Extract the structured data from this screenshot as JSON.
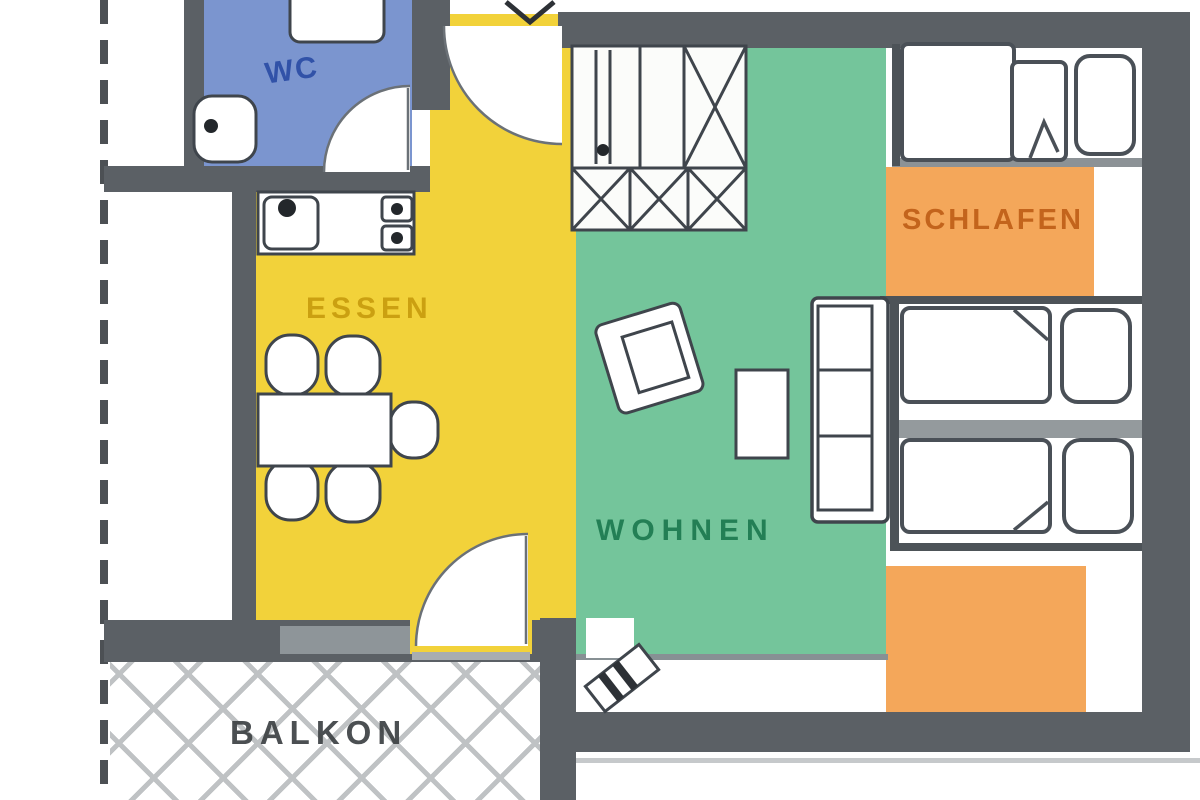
{
  "plan": {
    "type": "apartment-floor-plan",
    "rooms": {
      "wc": {
        "label": "WC",
        "color": "#7b95cf",
        "label_color": "#2c4da6"
      },
      "dining": {
        "label": "ESSEN",
        "color": "#f2d23a",
        "label_color": "#c99d0e"
      },
      "living": {
        "label": "WOHNEN",
        "color": "#74c59b",
        "label_color": "#1d7a50"
      },
      "sleeping": {
        "label": "SCHLAFEN",
        "color": "#f4a75a",
        "label_color": "#c06018"
      },
      "balcony": {
        "label": "BALKON",
        "label_color": "#3e4245"
      }
    },
    "colors": {
      "wall": "#5b6065",
      "furniture_outline": "#3f454c",
      "balcony_hatch": "#bfc2c4",
      "background": "#ffffff"
    },
    "furniture_icons": [
      "toilet-icon",
      "washbasin-icon",
      "door-swing-icon",
      "kitchen-counter-icon",
      "kitchen-sink-icon",
      "stove-icon",
      "dining-table-icon",
      "chair-icon",
      "wardrobe-icon",
      "armchair-icon",
      "side-table-icon",
      "sofa-icon",
      "bed-icon",
      "pillow-icon",
      "radiator-icon",
      "property-line-icon"
    ]
  }
}
